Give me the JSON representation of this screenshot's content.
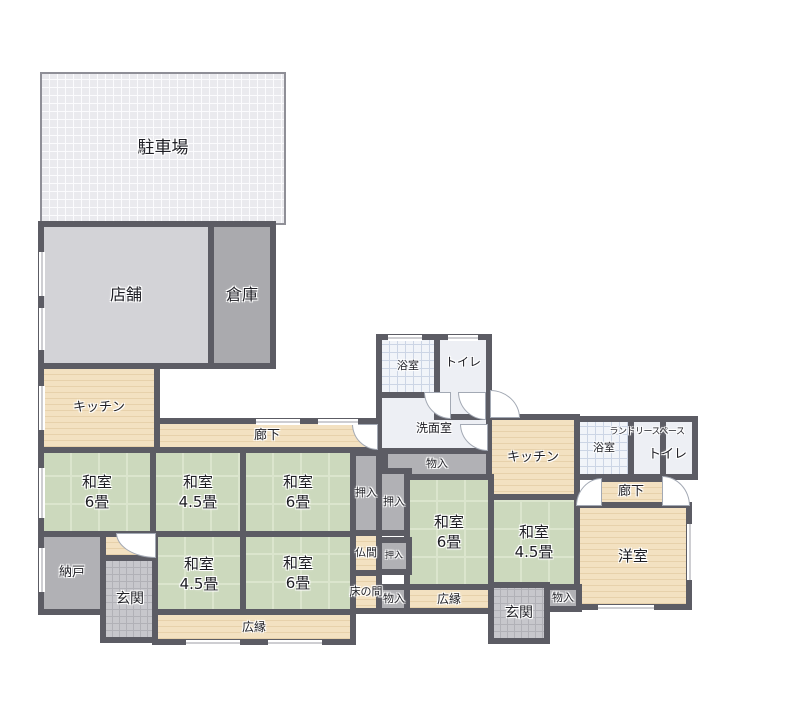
{
  "colors": {
    "wall": "#5c5c64",
    "tatami": "#ccd9bd",
    "wood_floor": "#f3e1c1",
    "storage_gray": "#b1b1b5",
    "shop_gray": "#d3d3d7",
    "warehouse_gray": "#aaaaae",
    "parking_gray": "#eaeaee",
    "bath_tile": "#f1f4f9",
    "genkan_gray": "#c7c7cc"
  },
  "rooms": {
    "parking": {
      "label": "駐車場"
    },
    "shop": {
      "label": "店舗"
    },
    "warehouse": {
      "label": "倉庫"
    },
    "kitchen_left": {
      "label": "キッチン"
    },
    "corridor_main": {
      "label": "廊下"
    },
    "bath_top": {
      "label": "浴室"
    },
    "toilet_top": {
      "label": "トイレ"
    },
    "washroom": {
      "label": "洗面室"
    },
    "kitchen_right": {
      "label": "キッチン"
    },
    "bath_right": {
      "label": "浴室"
    },
    "laundry": {
      "label": "ランドリースペース"
    },
    "toilet_right": {
      "label": "トイレ"
    },
    "corridor_right": {
      "label": "廊下"
    },
    "washitsu6_a": {
      "label": "和室",
      "size": "6畳"
    },
    "washitsu45_a": {
      "label": "和室",
      "size": "4.5畳"
    },
    "washitsu6_b": {
      "label": "和室",
      "size": "6畳"
    },
    "oshiire_a": {
      "label": "押入"
    },
    "oshiire_b": {
      "label": "押入"
    },
    "monoiri_top": {
      "label": "物入"
    },
    "washitsu6_c": {
      "label": "和室",
      "size": "6畳"
    },
    "washitsu45_b": {
      "label": "和室",
      "size": "4.5畳"
    },
    "youshitsu": {
      "label": "洋室"
    },
    "nando": {
      "label": "納戸"
    },
    "genkan_left": {
      "label": "玄関"
    },
    "washitsu45_c": {
      "label": "和室",
      "size": "4.5畳"
    },
    "washitsu6_d": {
      "label": "和室",
      "size": "6畳"
    },
    "butsuma": {
      "label": "仏間"
    },
    "oshiire_c": {
      "label": "押入"
    },
    "tokonoma": {
      "label": "床の間"
    },
    "monoiri_mid": {
      "label": "物入"
    },
    "hiroen_right": {
      "label": "広縁"
    },
    "genkan_right": {
      "label": "玄関"
    },
    "monoiri_right": {
      "label": "物入"
    },
    "hiroen_bottom": {
      "label": "広縁"
    }
  }
}
